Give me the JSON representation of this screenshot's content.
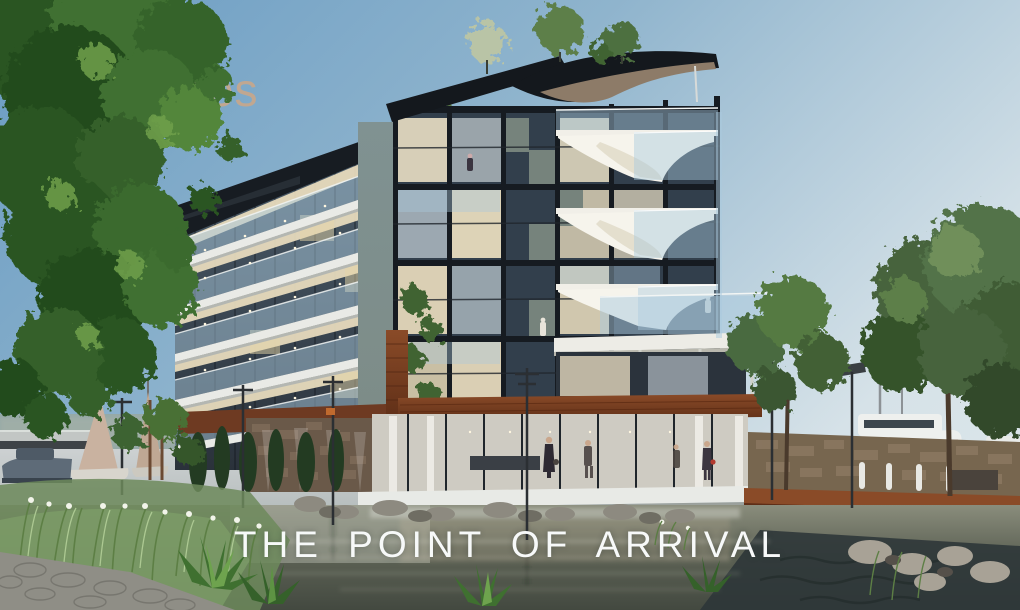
{
  "tagline": {
    "text": "THE POINT OF ARRIVAL",
    "color": "#f7f9f9"
  },
  "watermark": {
    "text": "prehomes",
    "part1": "pre",
    "part2": "homes",
    "part1_color": "#33465f",
    "part2_color": "#c7a78c"
  },
  "colors": {
    "sky_top": "#6a9cc3",
    "sky_horizon": "#d6e2e8",
    "water_light": "#c5cacc",
    "water_dark": "#313a3d",
    "wood_accent": "#7c4126",
    "roof_dark": "#171c22",
    "glass_blue": "#a9c9dd",
    "warm_light": "#ecdfc0",
    "foliage_green": "#47682f",
    "watermark_navy": "#33465f",
    "watermark_tan": "#c7a78c",
    "tagline_white": "#f7f9f9"
  },
  "scene": {
    "elements": [
      "left-tree",
      "watermark-logo",
      "apartment-building",
      "left-wing-balconies",
      "central-glass-tower",
      "right-sail-balconies",
      "roof-canopy",
      "rooftop-garden",
      "ground-floor-lobby",
      "people",
      "sailboats",
      "rowboat",
      "bridge",
      "motor-yacht",
      "stone-seawall",
      "timber-boardwalk",
      "light-poles",
      "water",
      "rocks",
      "reeds",
      "agave-plants",
      "stone-pavement",
      "right-trees",
      "tagline"
    ]
  }
}
